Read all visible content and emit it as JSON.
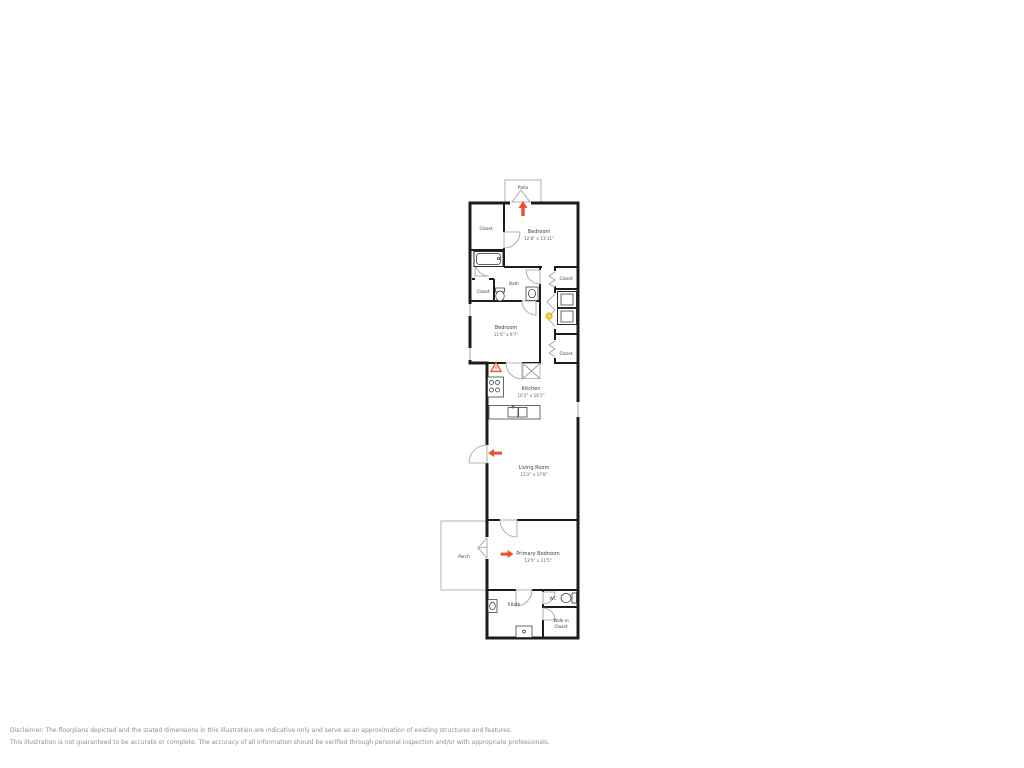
{
  "colors": {
    "wall": "#1c1c1c",
    "accent_red": "#e8512e",
    "accent_yellow": "#f0c000",
    "outdoor_outline": "#c8c8c8",
    "door_arc": "#9b9b9b",
    "label": "#3c3c3c",
    "dims": "#606060",
    "disclaimer": "#8f8f8f"
  },
  "icons": {
    "entry_arrow_up": "arrow-up",
    "entry_arrow_left": "arrow-left",
    "entry_arrow_right": "arrow-right",
    "utility_triangle": "warning-triangle",
    "fixture_dot": "yellow-circle"
  },
  "floorplan": {
    "patio": {
      "label": "Patio"
    },
    "closet_top_left": {
      "label": "Closet"
    },
    "bedroom_top": {
      "label": "Bedroom",
      "dims": "12'8\" x 13'11\""
    },
    "bath": {
      "label": "Bath"
    },
    "closet_small": {
      "label": "Closet"
    },
    "bedroom_mid": {
      "label": "Bedroom",
      "dims": "11'6\" x 9'7\""
    },
    "closet_right_top": {
      "label": "Closet"
    },
    "closet_right_bottom": {
      "label": "Closet"
    },
    "kitchen": {
      "label": "Kitchen",
      "dims": "10'2\" x 16'2\""
    },
    "living_room": {
      "label": "Living Room",
      "dims": "15'2\" x 17'8\""
    },
    "porch": {
      "label": "Porch"
    },
    "primary_bedroom": {
      "label": "Primary Bedroom",
      "dims": "13'5\" x 11'5\""
    },
    "primary_bath": {
      "label": "P.Bath"
    },
    "wc": {
      "label": "WC"
    },
    "walk_in_closet": {
      "line1": "Walk-in",
      "line2": "Closet"
    }
  },
  "disclaimer": {
    "line1": "Disclaimer: The floorplans depicted and the stated dimensions in this illustration are indicative only and serve as an approximation of existing structures and features.",
    "line2": "This illustration is not guaranteed to be accurate or complete. The accuracy of all information should be verified through personal inspection and/or with appropriate professionals."
  }
}
